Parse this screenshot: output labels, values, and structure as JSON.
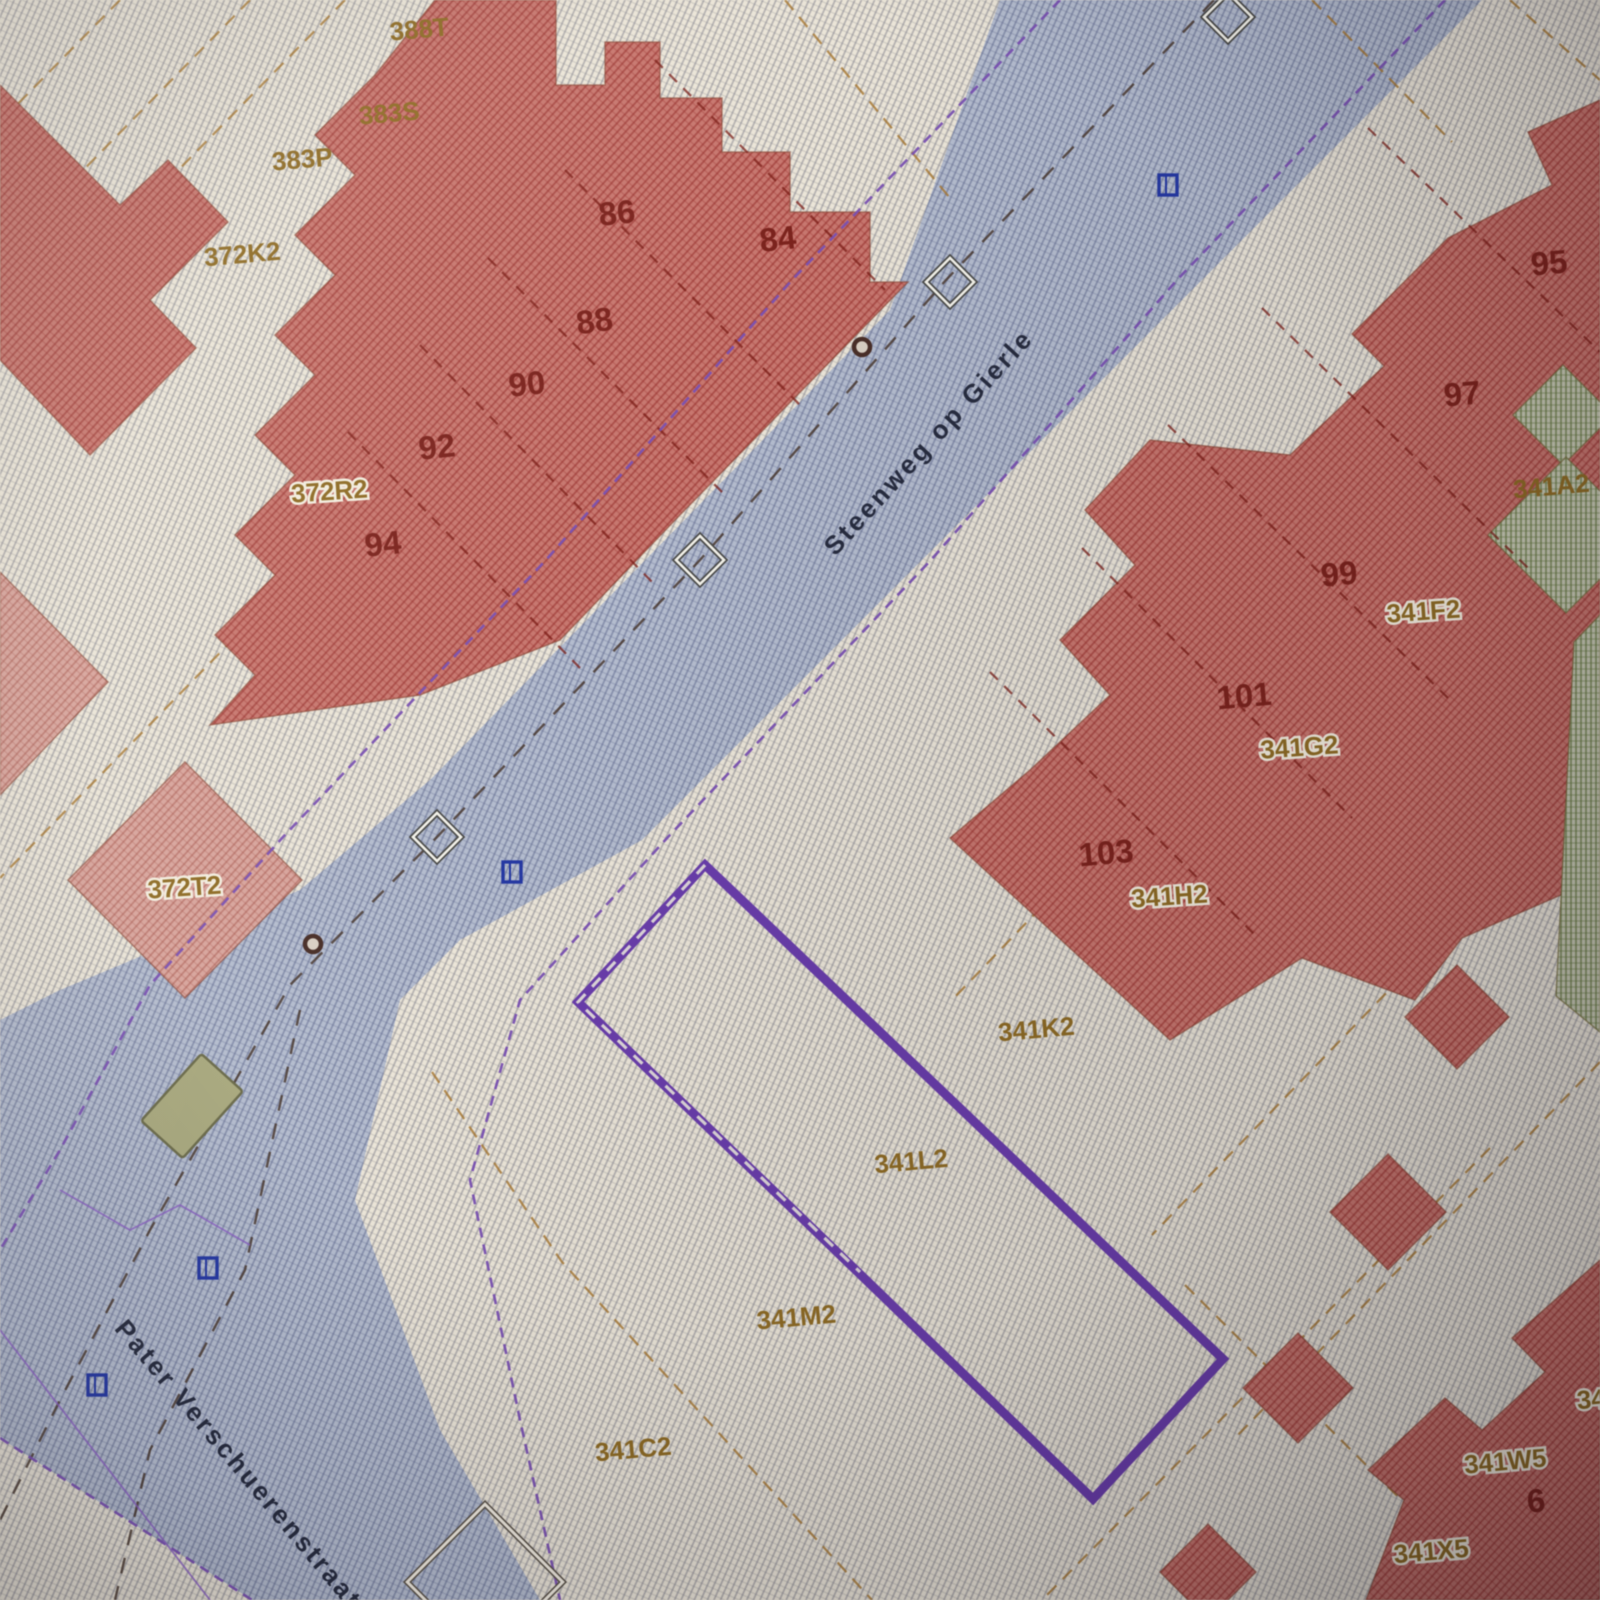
{
  "map_type": "cadastral-parcel-map",
  "selection": {
    "selected_parcel": "341L2"
  },
  "streets": [
    "Steenweg op Gierle",
    "Pater Verschuerenstraat"
  ],
  "parcels": [
    "388T",
    "383S",
    "383P",
    "372K2",
    "372R2",
    "372T2",
    "341A2",
    "341F2",
    "341G2",
    "341H2",
    "341K2",
    "341L2",
    "341M2",
    "341C2",
    "341W5",
    "341X5",
    "34"
  ],
  "houses": [
    "86",
    "84",
    "88",
    "90",
    "92",
    "94",
    "95",
    "97",
    "99",
    "101",
    "103",
    "6"
  ],
  "colors": {
    "building_fill": "#c9766f",
    "pink_fill": "#d9a49b",
    "road_fill": "#b3bacd",
    "vegetation_fill": "#c6c8b2",
    "selected_outline": "#6a3cae",
    "parcel_boundary": "#a8762c",
    "utility_line": "#7a4fb5",
    "road_centerline": "#4a3a30",
    "house_number_text": "#7e221c",
    "parcel_code_text": "#8f6b22",
    "street_name_text": "#272c40",
    "survey_marker": "#f3f2ea",
    "hydrant_marker": "#2438a6"
  }
}
